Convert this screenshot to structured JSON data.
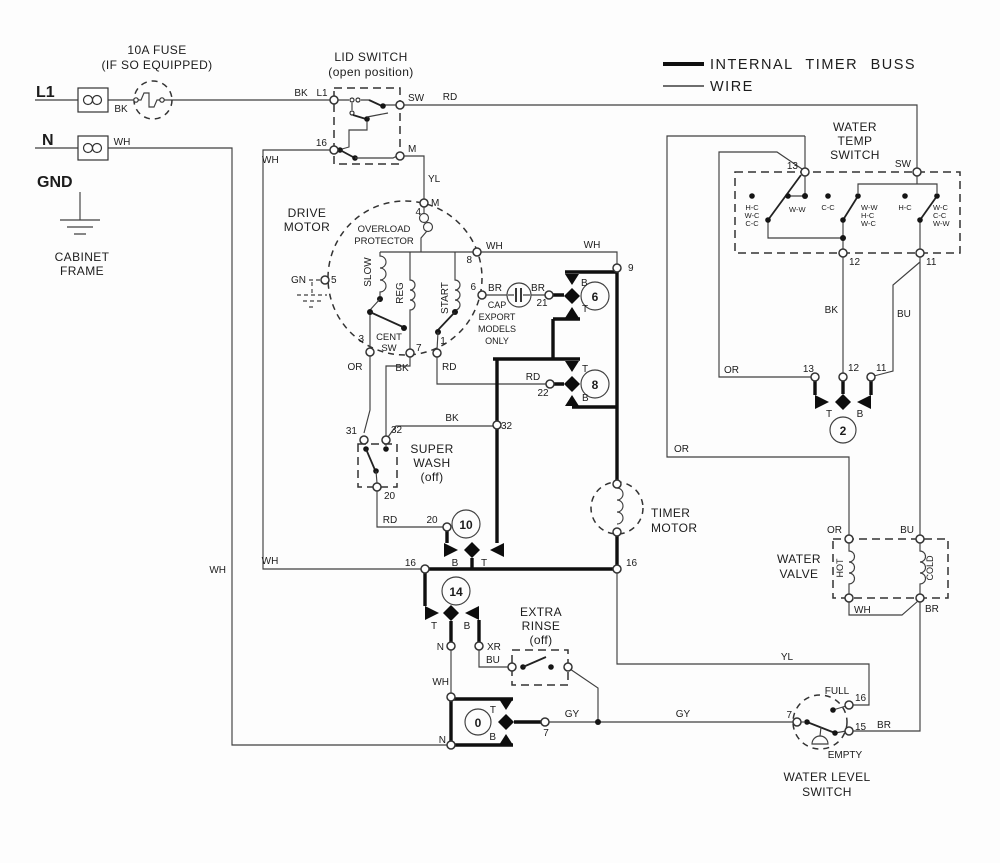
{
  "legend": {
    "buss": "INTERNAL TIMER BUSS",
    "wire": "WIRE"
  },
  "power": {
    "l1": "L1",
    "n": "N",
    "gnd": "GND",
    "fuse1": "10A FUSE",
    "fuse2": "(IF SO EQUIPPED)",
    "cab1": "CABINET",
    "cab2": "FRAME",
    "bk": "BK",
    "wh": "WH"
  },
  "lid": {
    "t1": "LID SWITCH",
    "t2": "(open position)",
    "bk": "BK",
    "l1": "L1",
    "sw": "SW",
    "rd": "RD",
    "n16": "16",
    "wh": "WH",
    "m": "M",
    "yl": "YL"
  },
  "motor": {
    "t1": "DRIVE",
    "t2": "MOTOR",
    "ov1": "OVERLOAD",
    "ov2": "PROTECTOR",
    "m": "M",
    "n4": "4",
    "gn": "GN",
    "n5": "5",
    "slow": "SLOW",
    "reg": "REG",
    "start": "START",
    "cent1": "CENT",
    "cent2": "SW",
    "n3": "3",
    "n7": "7",
    "n1": "1",
    "n8": "8",
    "n6": "6",
    "wh": "WH",
    "br": "BR",
    "or": "OR",
    "bk": "BK",
    "rd": "RD"
  },
  "cap": {
    "l1": "CAP",
    "l2": "EXPORT",
    "l3": "MODELS",
    "l4": "ONLY",
    "br": "BR",
    "n21": "21"
  },
  "c6": {
    "num": "6",
    "b": "B",
    "t": "T",
    "n9": "9",
    "wh": "WH"
  },
  "c8": {
    "num": "8",
    "t": "T",
    "b": "B",
    "rd": "RD",
    "n22": "22"
  },
  "superwash": {
    "t1": "SUPER",
    "t2": "WASH",
    "t3": "(off)",
    "n31": "31",
    "n32": "32",
    "n20": "20",
    "rd": "RD",
    "bk2": "BK",
    "n32b": "32"
  },
  "c10": {
    "num": "10",
    "n20": "20",
    "b": "B",
    "t": "T"
  },
  "buss16": {
    "l16": "16",
    "r16": "16",
    "wh": "WH"
  },
  "timer": {
    "t1": "TIMER",
    "t2": "MOTOR"
  },
  "c14": {
    "num": "14",
    "t": "T",
    "b": "B",
    "n": "N",
    "xr": "XR",
    "wh": "WH",
    "bu": "BU"
  },
  "er": {
    "t1": "EXTRA",
    "t2": "RINSE",
    "t3": "(off)"
  },
  "c0": {
    "num": "0",
    "t": "T",
    "b": "B",
    "n7": "7",
    "n": "N",
    "gy1": "GY",
    "gy2": "GY"
  },
  "wt": {
    "t1": "WATER",
    "t2": "TEMP",
    "t3": "SWITCH",
    "n13": "13",
    "sw": "SW",
    "n12": "12",
    "n11": "11",
    "g1a": "H-C",
    "g1b": "W-C",
    "g1c": "C-C",
    "s1": "W-W",
    "g2": "C-C",
    "s2a": "W-W",
    "s2b": "H-C",
    "s2c": "W-C",
    "g3": "H-C",
    "s3a": "W-C",
    "s3b": "C-C",
    "s3c": "W-W"
  },
  "c2": {
    "num": "2",
    "n13": "13",
    "n12": "12",
    "n11": "11",
    "t": "T",
    "b": "B",
    "or": "OR",
    "bk": "BK",
    "bu": "BU"
  },
  "valve": {
    "t1": "WATER",
    "t2": "VALVE",
    "hot": "HOT",
    "cold": "COLD",
    "or": "OR",
    "bu": "BU",
    "wh": "WH",
    "br": "BR"
  },
  "wl": {
    "t1": "WATER LEVEL",
    "t2": "SWITCH",
    "full": "FULL",
    "empty": "EMPTY",
    "n7": "7",
    "n16": "16",
    "n15": "15",
    "br": "BR",
    "yl": "YL"
  },
  "wires": {
    "wh_left": "WH",
    "wh_16": "WH",
    "or_mid": "OR"
  }
}
